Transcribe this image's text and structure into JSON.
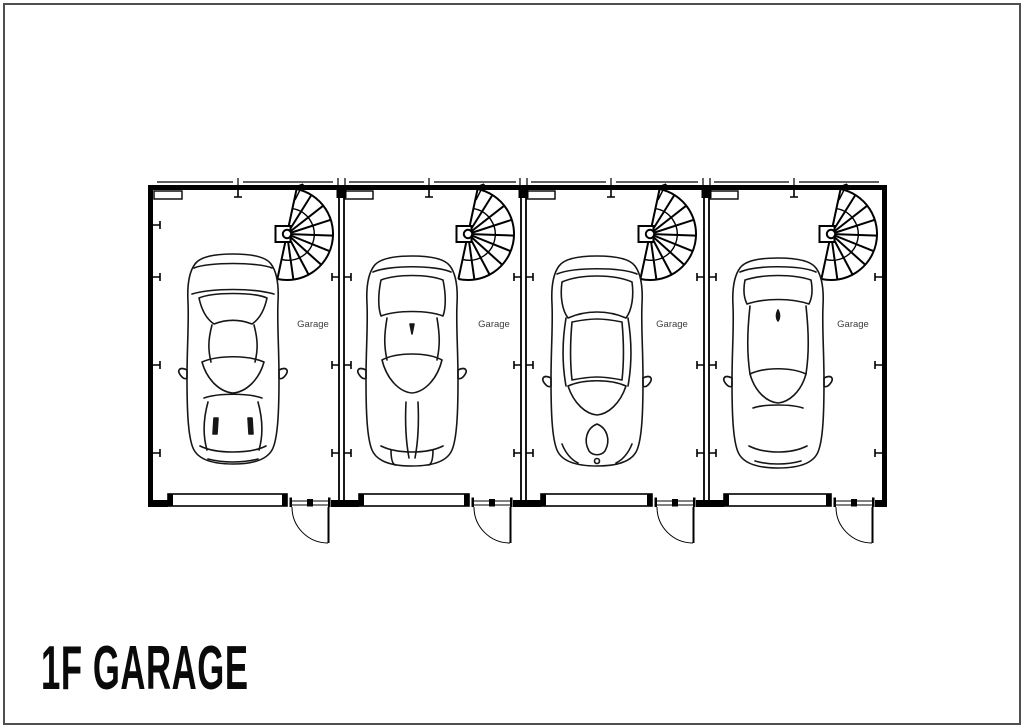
{
  "title": "1F GARAGE",
  "colors": {
    "drawing_line": "#000000",
    "garage_label_text": "#3d3d3d",
    "page_border": "#4f4f4f",
    "background": "#ffffff"
  },
  "floor_plan": {
    "bays": [
      {
        "name": "bay-1",
        "label": "Garage"
      },
      {
        "name": "bay-2",
        "label": "Garage"
      },
      {
        "name": "bay-3",
        "label": "Garage"
      },
      {
        "name": "bay-4",
        "label": "Garage"
      }
    ],
    "icons": {
      "car": "car-top-view-icon",
      "staircase": "spiral-staircase-icon",
      "garage_door": "garage-door-symbol",
      "entry_door": "door-swing-symbol"
    }
  }
}
